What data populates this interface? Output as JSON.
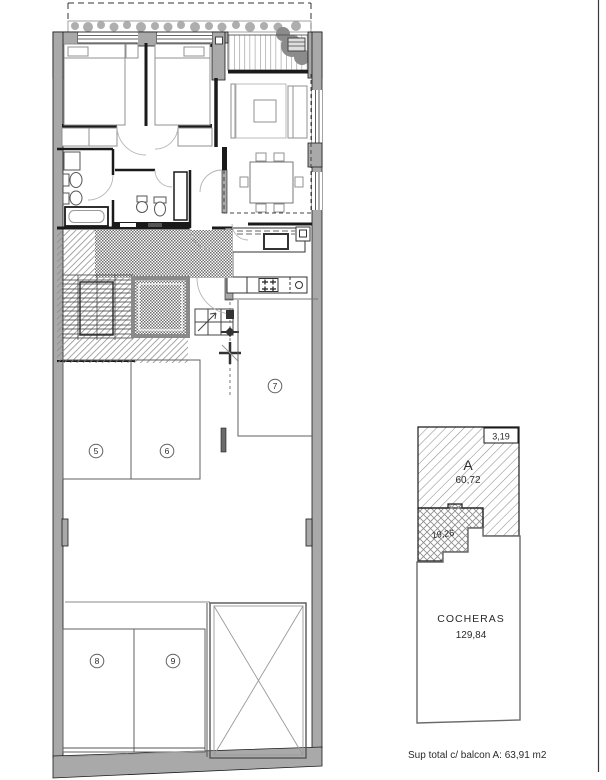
{
  "plan": {
    "parking_labels": [
      "5",
      "6",
      "7",
      "8",
      "9"
    ]
  },
  "unit_diagram": {
    "unit_label": "A",
    "unit_area": "60,72",
    "balcony_area": "3,19",
    "patio_area": "19,26",
    "garage_label": "COCHERAS",
    "garage_area": "129,84"
  },
  "footer": {
    "summary": "Sup total c/ balcon A:  63,91 m2"
  },
  "colors": {
    "wall": "#a9a9a9",
    "line": "#1a1a1a",
    "hatch": "#8f8f8f"
  }
}
